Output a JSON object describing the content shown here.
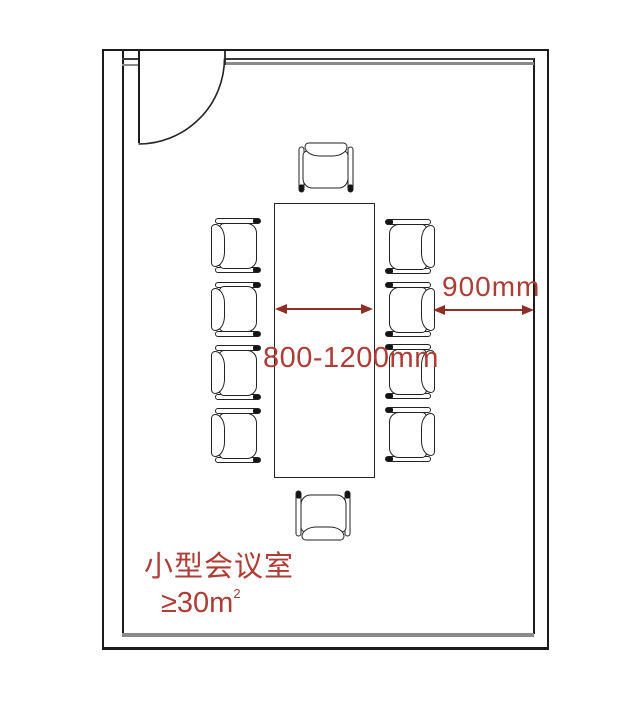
{
  "diagram": {
    "type": "floor-plan",
    "room": {
      "name_label": "小型会议室",
      "area_label": "≥30m",
      "area_superscript": "2"
    },
    "dimensions": {
      "table_width": "800-1200mm",
      "wall_clearance": "900mm"
    },
    "furniture": {
      "table": "rectangular-conference-table",
      "chairs_total": 10,
      "chairs_left_column": 4,
      "chairs_right_column": 4,
      "chairs_head": 1,
      "chairs_foot": 1
    },
    "door": {
      "position": "top-left",
      "type": "single-swing-door-quarter-arc"
    }
  },
  "colors": {
    "annotation_text": "#ad3d35",
    "annotation_arrow": "#8e2f27",
    "wall_line": "#1b1b1b",
    "inner_wall_gray": "#8a8a8a",
    "background": "#ffffff"
  }
}
